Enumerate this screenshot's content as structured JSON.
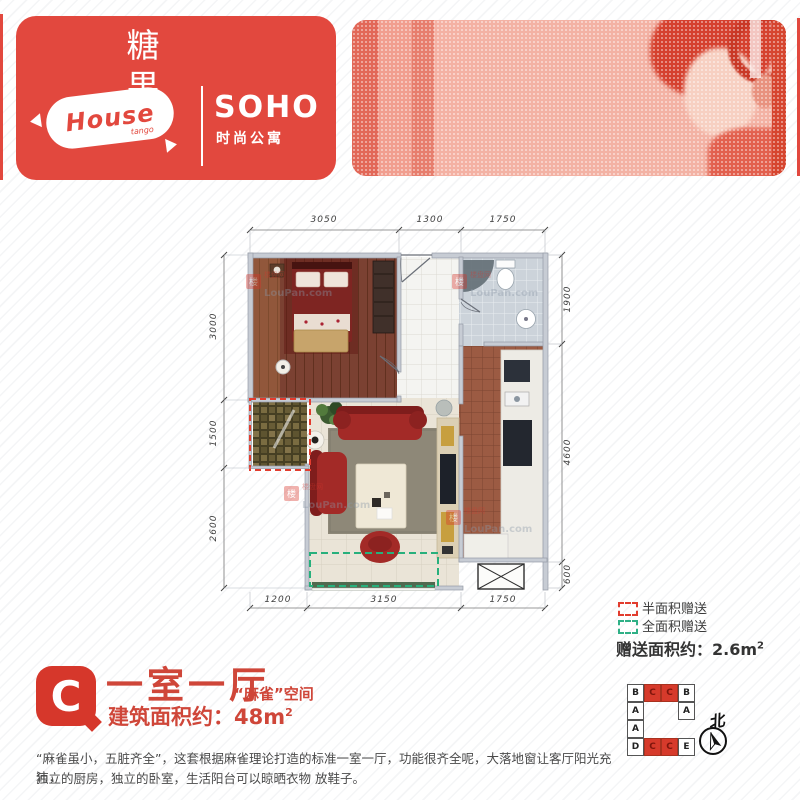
{
  "brand": {
    "candy_cn": "糖果",
    "candy_suffix": "er",
    "house": "House",
    "house_sub": "tango",
    "soho": "SOHO",
    "soho_sub": "时尚公寓"
  },
  "plan": {
    "dims": {
      "top": [
        "3050",
        "1300",
        "1750"
      ],
      "bottom": [
        "1200",
        "3150",
        "1750"
      ],
      "left": [
        "3000",
        "1500",
        "2600"
      ],
      "right": [
        "1900",
        "4600",
        "600"
      ]
    },
    "watermark": {
      "icon": "楼",
      "cn": "楼盘网",
      "en": "LouPan.com"
    }
  },
  "legend": {
    "half_label": "半面积赠送",
    "full_label": "全面积赠送",
    "gift_text": "赠送面积约：2.6m",
    "gift_sup": "2",
    "half_color": "#e23c2e",
    "full_color": "#2eb086"
  },
  "unit": {
    "badge": "C",
    "title": "一室一厅",
    "subtitle": "“麻雀”空间",
    "area_text": "建筑面积约：48m",
    "area_sup": "2",
    "desc_line1": "“麻雀虽小，五脏齐全”，这套根据麻雀理论打造的标准一室一厅，功能很齐全呢，大落地窗让客厅阳光充沛，",
    "desc_line2": "独立的厨房，独立的卧室，生活阳台可以晾晒衣物 放鞋子。"
  },
  "keyplan": {
    "cells": [
      [
        "B",
        "C",
        "C",
        "B"
      ],
      [
        "A",
        "",
        "",
        "A"
      ],
      [
        "A",
        "",
        "",
        ""
      ],
      [
        "D",
        "C",
        "C",
        "E"
      ]
    ],
    "compass": "北"
  },
  "colors": {
    "brand_red": "#e2483e",
    "accent_red": "#d6372b"
  }
}
